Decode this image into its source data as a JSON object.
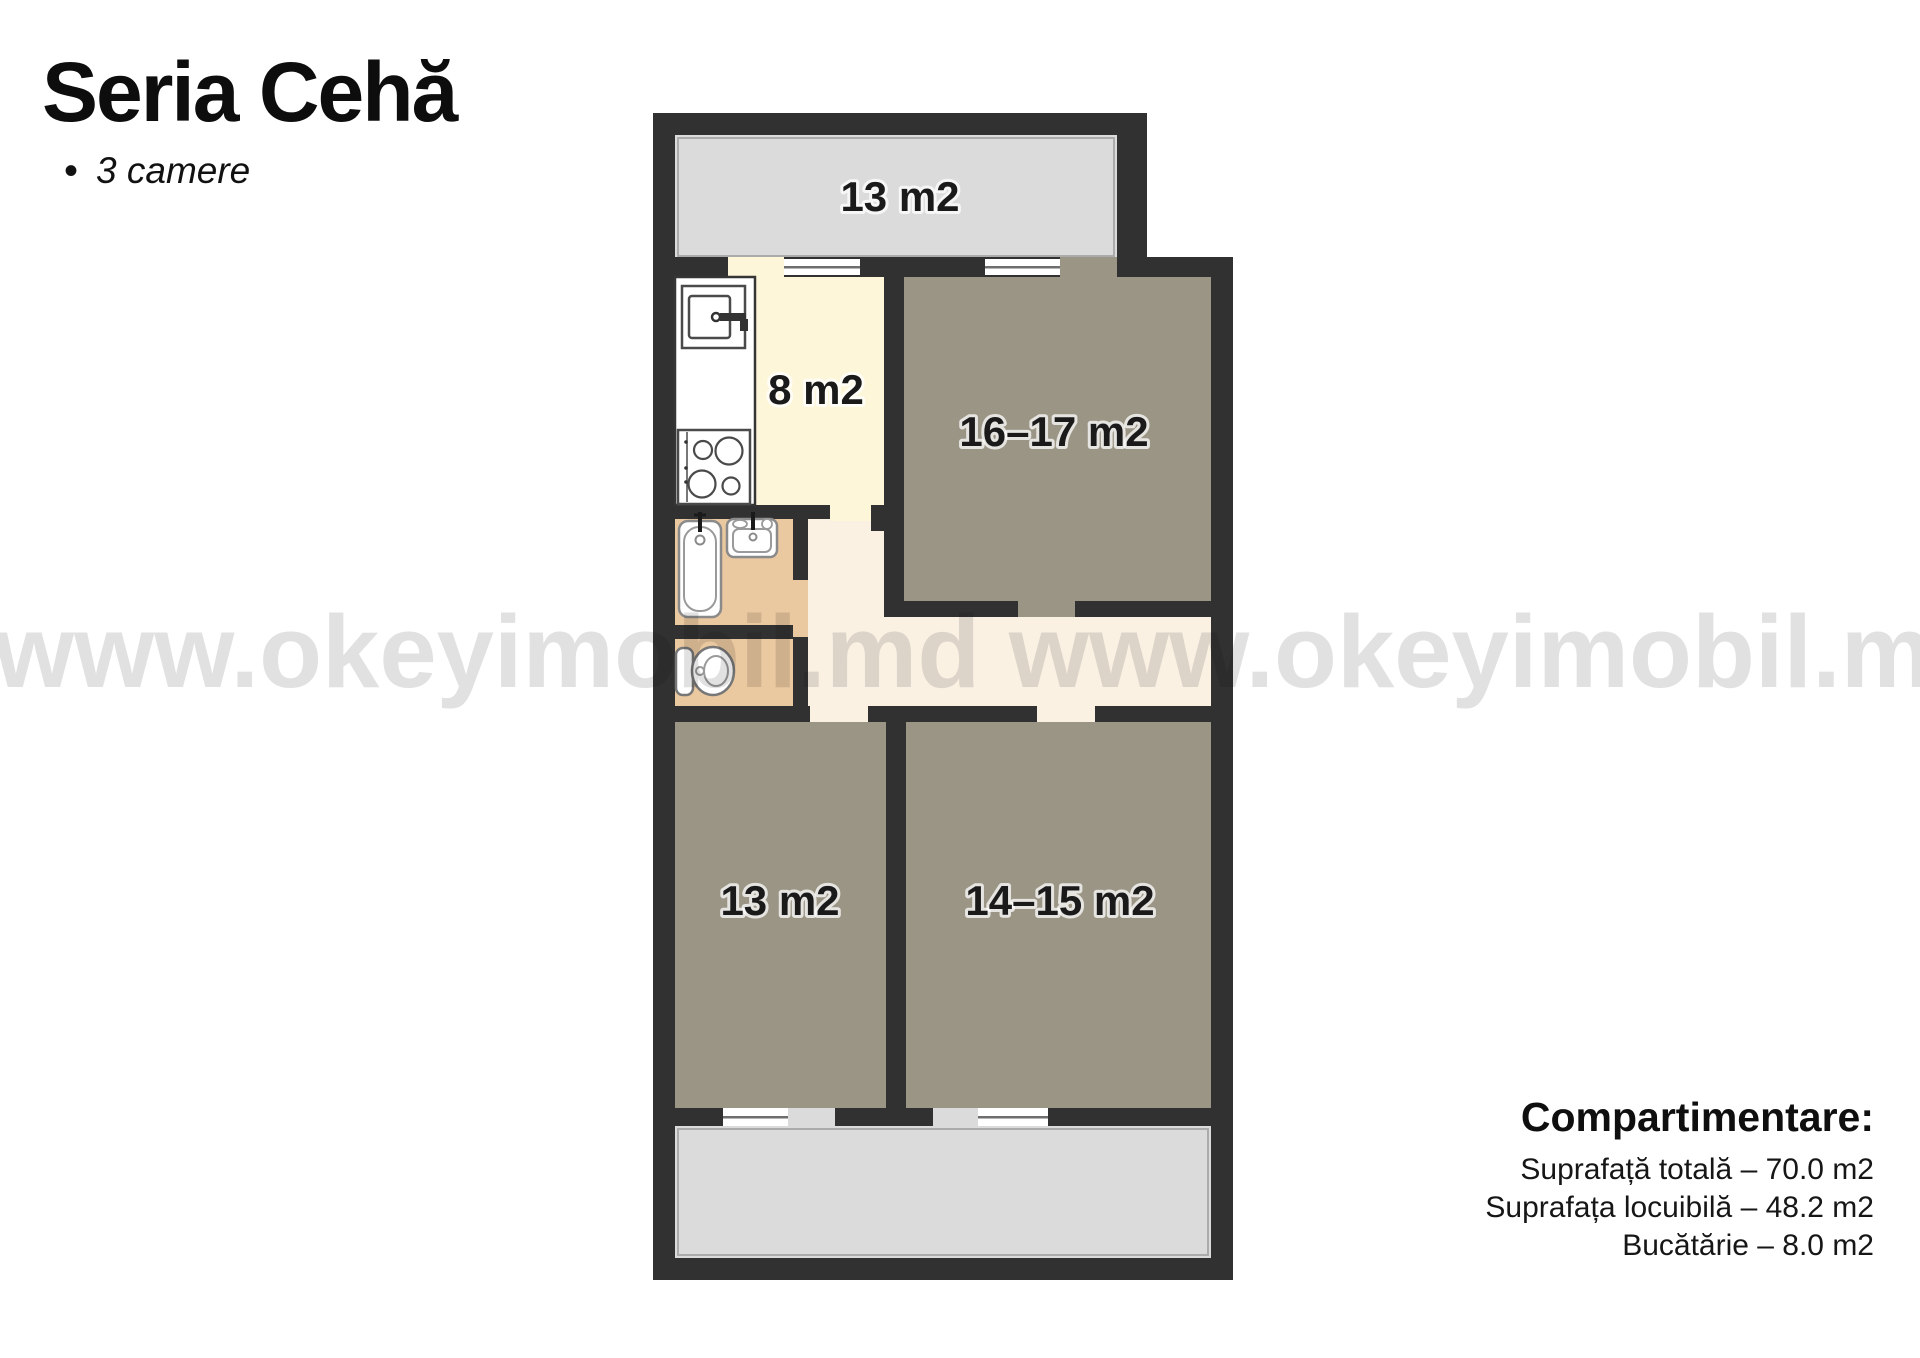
{
  "header": {
    "title": "Seria Cehă",
    "bullet": "•",
    "subtitle": "3 camere"
  },
  "watermark": {
    "text": "www.okeyimobil.md www.okeyimobil.md",
    "color": "#e1e1e1"
  },
  "floor_plan": {
    "rooms": [
      {
        "name": "balcon-sus",
        "type": "balcony",
        "label": "13 m2"
      },
      {
        "name": "bucatarie",
        "type": "kitchen",
        "label": "8 m2"
      },
      {
        "name": "camera-mare",
        "type": "room",
        "label": "16–17 m2"
      },
      {
        "name": "camera-jos-stanga",
        "type": "room",
        "label": "13 m2"
      },
      {
        "name": "camera-jos-dreapta",
        "type": "room",
        "label": "14–15 m2"
      }
    ],
    "fixtures": [
      "kitchen-sink",
      "stove",
      "bathtub",
      "bathroom-sink",
      "toilet"
    ],
    "colors": {
      "wall": "#313131",
      "balcony": "#dbdbdb",
      "room": "#9b9585",
      "kitchen": "#fdf6d9",
      "hallway": "#faf1e3",
      "bathroom": "#eac8a0",
      "window": "#ffffff"
    }
  },
  "summary": {
    "heading": "Compartimentare:",
    "lines": [
      {
        "text": "Suprafață totală – 70.0 m2"
      },
      {
        "text": "Suprafața locuibilă – 48.2 m2"
      },
      {
        "text": "Bucătărie – 8.0 m2"
      }
    ]
  }
}
